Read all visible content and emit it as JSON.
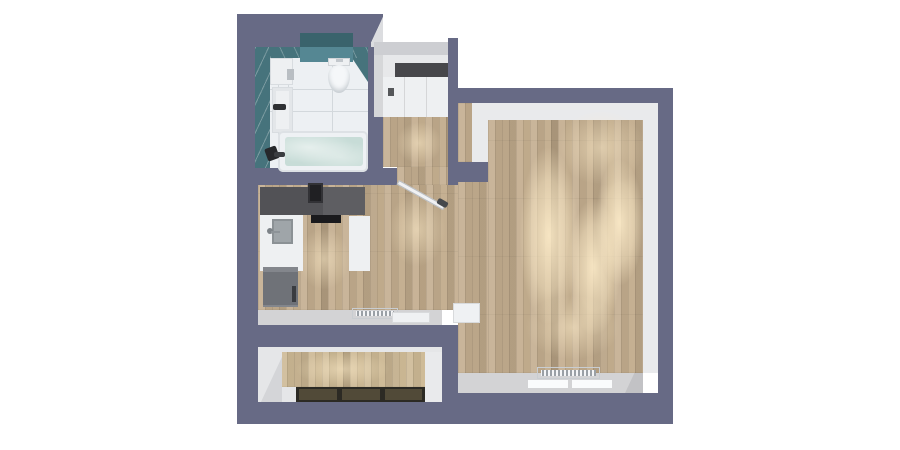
{
  "scene": {
    "title": "3D top-down floor plan render of a studio apartment",
    "view": "top-down axonometric",
    "background": "white"
  },
  "palette": {
    "outer_wall": "#676a85",
    "inner_trim": "#e9eaec",
    "ledge_gray": "#d3d3d5",
    "wood_floor": "#c3ad8e",
    "wood_floor_balcony": "#cdb995",
    "floor_glow": "#ffeecd",
    "bathroom_tile_teal": "#46737c",
    "bathroom_tile_teal_dark": "#3a636c",
    "bathroom_tile_teal_light": "#558793",
    "bathroom_floor_white": "#edf0f3",
    "bathtub_water": "#c7dcd7",
    "kitchen_counter_dark": "#55555a",
    "cooktop_black": "#1a1a1d",
    "fixture_white": "#eef0f2",
    "fridge_gray": "#7d8086",
    "wardrobe_top_dark": "#47474b",
    "balcony_window_panel": "#514a38",
    "balcony_window_frame": "#2c2a24"
  },
  "rooms": {
    "bathroom": {
      "name": "Bathroom",
      "objects": [
        "teal tiled walls",
        "toilet with cistern shelf",
        "washer cabinet",
        "tall cabinet",
        "bathtub filled with water",
        "faucet"
      ]
    },
    "hallway": {
      "name": "Entry hall",
      "objects": [
        "wardrobe with dark top",
        "wood floor",
        "open interior door"
      ]
    },
    "kitchen": {
      "name": "Kitchen",
      "objects": [
        "dark upper counter run",
        "range hood",
        "black cooktop",
        "sink with faucet",
        "white counters",
        "fridge",
        "radiator",
        "window sill"
      ]
    },
    "living_room": {
      "name": "Living room",
      "objects": [
        "wood plank floor with light pools",
        "radiator under window",
        "window sills",
        "wall niche"
      ]
    },
    "balcony": {
      "name": "Balcony",
      "objects": [
        "wood deck",
        "three dark glazing panels"
      ]
    }
  },
  "door": {
    "state": "open",
    "swing_angle_deg": 29,
    "location": "between entry hall and living area"
  }
}
